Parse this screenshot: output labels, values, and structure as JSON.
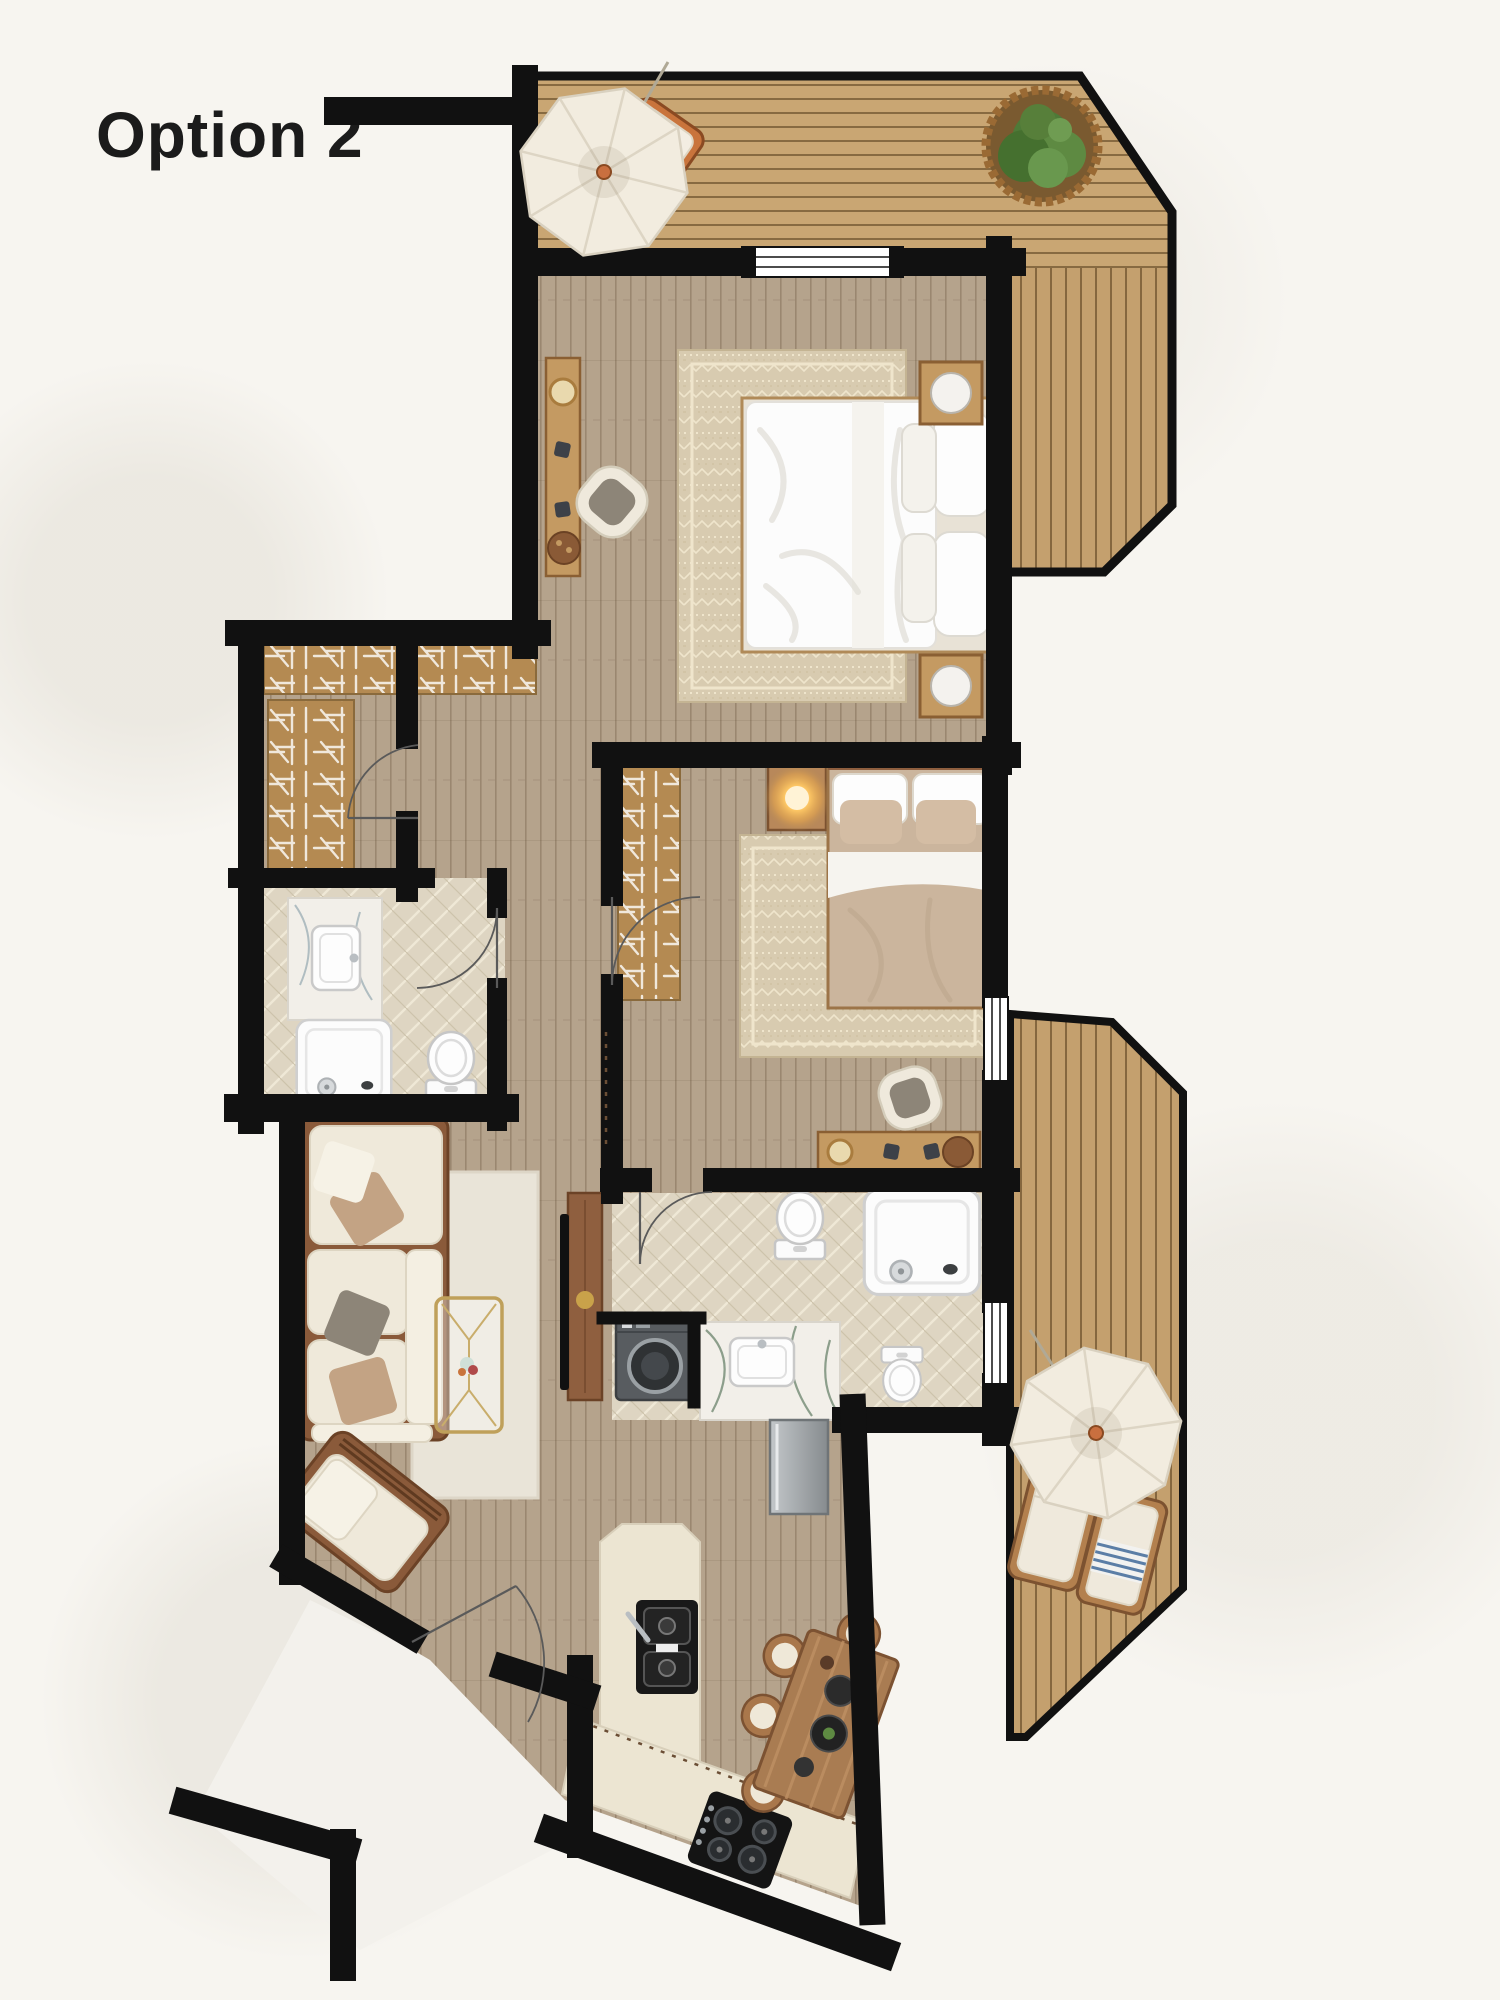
{
  "title": "Option 2",
  "colors": {
    "background": "#f7f5f0",
    "ink": "#1b1b1b",
    "wall": "#111111",
    "deck_wood": "#c9a673",
    "floor_wood": "#b5a38c",
    "bath_tile": "#ded5c2",
    "wardrobe_wood": "#b48a52",
    "rug_beige": "#d8cbb0",
    "rug_living": "#e9e4d8",
    "sofa_frame": "#8a5a3a",
    "cushion_cream": "#efe9da",
    "oak_furniture": "#c49a62",
    "walnut": "#8f5f3f",
    "fixture_white": "#fbfbfb",
    "washer_gray": "#585c60",
    "marble_white": "#f2efe9",
    "stone_counter": "#ece5d2",
    "appliance_black": "#161616",
    "dining_wood": "#a97c52",
    "umbrella_cream": "#f2ecdf",
    "plant_green": "#55793c",
    "lamp_glow": "#ffc966",
    "terracotta": "#c9743c"
  },
  "floorplan": {
    "option_label": "Option 2",
    "rooms": [
      "terrace-top",
      "terrace-right",
      "master-bedroom",
      "walk-in-closet",
      "ensuite-bathroom",
      "hallway",
      "second-bedroom",
      "main-bathroom-laundry",
      "living-room",
      "kitchen",
      "dining-area",
      "entry-corridor"
    ],
    "furniture": [
      "parasol",
      "sun-lounger",
      "planter",
      "double-bed",
      "nightstand",
      "desk",
      "desk-chair",
      "area-rug",
      "wardrobe",
      "table-lamp",
      "vanity-sink",
      "shower",
      "toilet",
      "bidet",
      "sectional-sofa",
      "armchair",
      "coffee-table",
      "tv-console",
      "washing-machine",
      "kitchen-island",
      "kitchen-sink",
      "cooktop",
      "fridge",
      "dining-table",
      "dining-chair"
    ]
  }
}
